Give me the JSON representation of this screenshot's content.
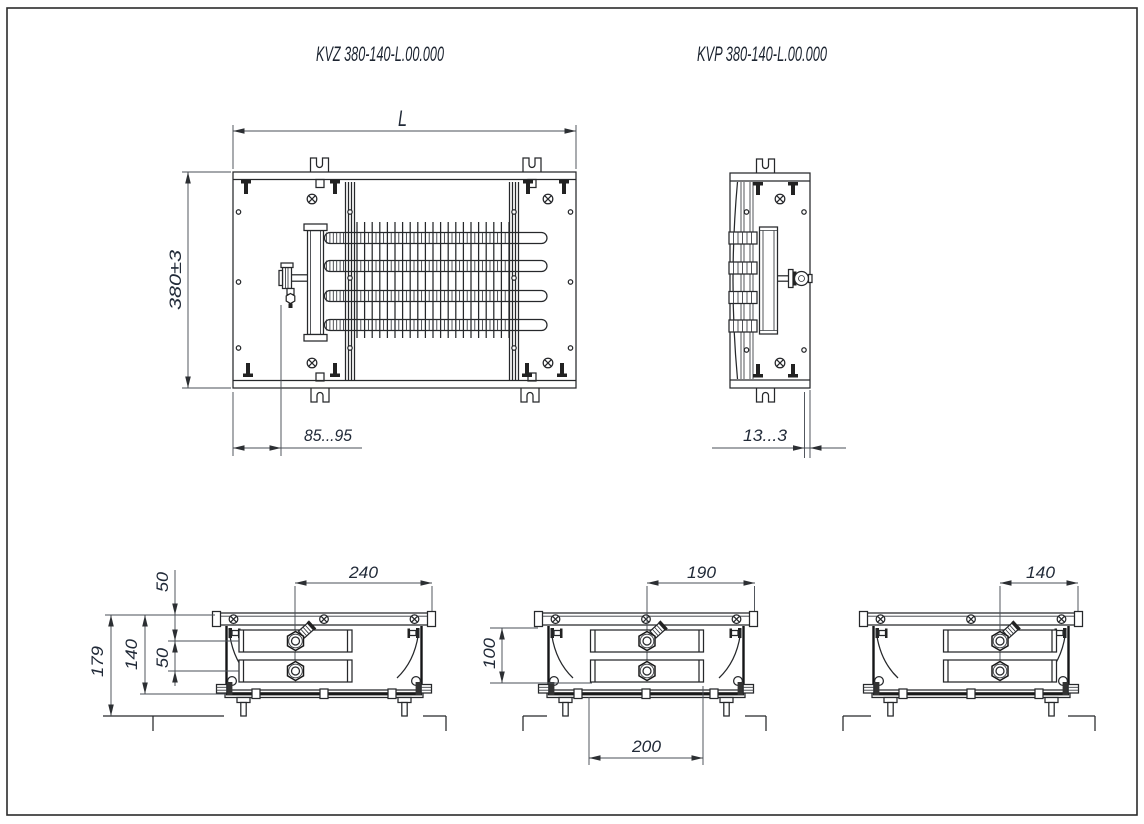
{
  "page": {
    "titles": {
      "kvz": "KVZ 380-140-L.00.000",
      "kvp": "KVP 380-140-L.00.000"
    }
  },
  "dims": {
    "length": "L",
    "width": "380±3",
    "valve_offset": "85...95",
    "valve_protrusion": "13...3",
    "a_axis_to_edge": "240",
    "a_total_height": "179",
    "a_casing_height": "140",
    "a_top_to_axis": "50",
    "a_axis_spacing": "50",
    "b_axis_to_edge": "190",
    "b_inner_height": "100",
    "b_block_width": "200",
    "c_axis_to_edge": "140"
  }
}
